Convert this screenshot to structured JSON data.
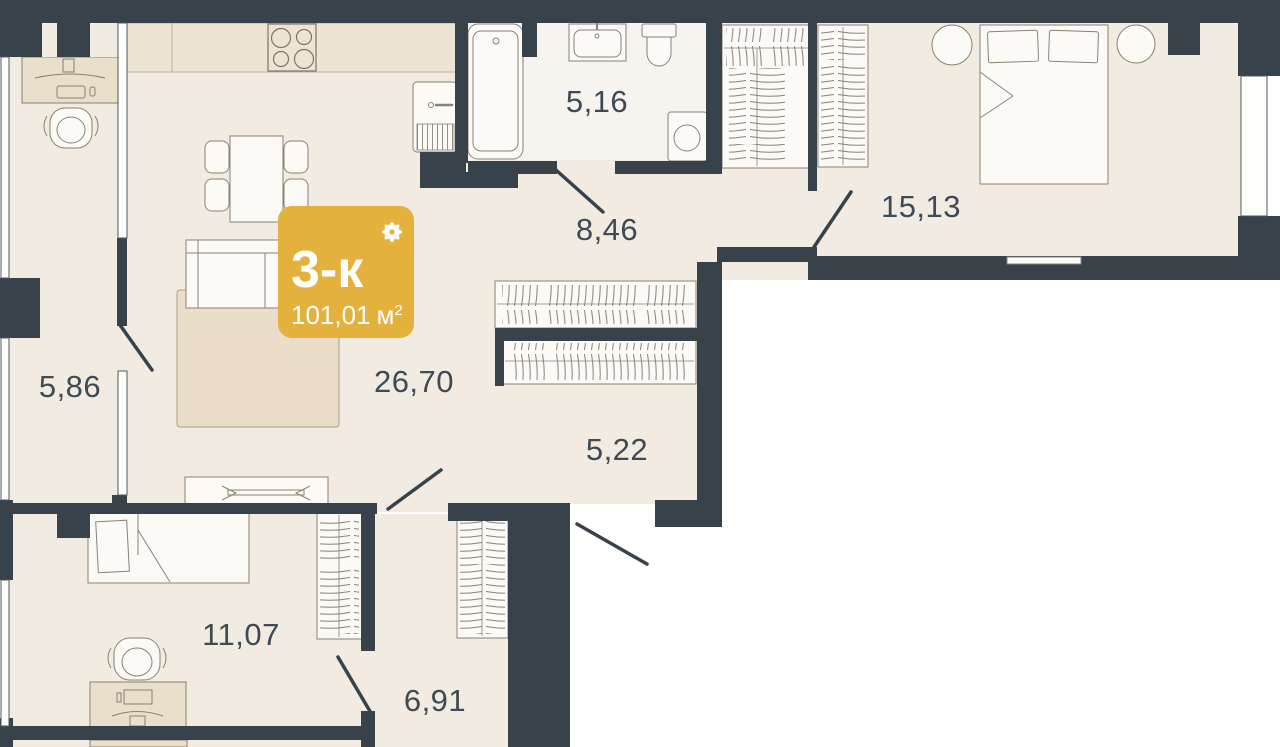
{
  "plan": {
    "badge": {
      "rooms_label": "3-к",
      "area_value": "101,01",
      "area_unit": "м",
      "area_sup": "2",
      "color": "#E4B13C"
    },
    "rooms": [
      {
        "id": "bathroom",
        "area": "5,16"
      },
      {
        "id": "hallway-main",
        "area": "8,46"
      },
      {
        "id": "bedroom-master",
        "area": "15,13"
      },
      {
        "id": "balcony",
        "area": "5,86"
      },
      {
        "id": "living-kitchen",
        "area": "26,70"
      },
      {
        "id": "corridor",
        "area": "5,22"
      },
      {
        "id": "bedroom-second",
        "area": "11,07"
      },
      {
        "id": "hallway-entry",
        "area": "6,91"
      }
    ],
    "colors": {
      "wall": "#37424B",
      "floor": "#F1EBE1",
      "floor_bath": "#F7F4EF",
      "furniture_beige": "#E9DFCB",
      "fixture_white": "#FBFAF7",
      "outline": "#8A8274",
      "label": "#3F4A54"
    }
  }
}
